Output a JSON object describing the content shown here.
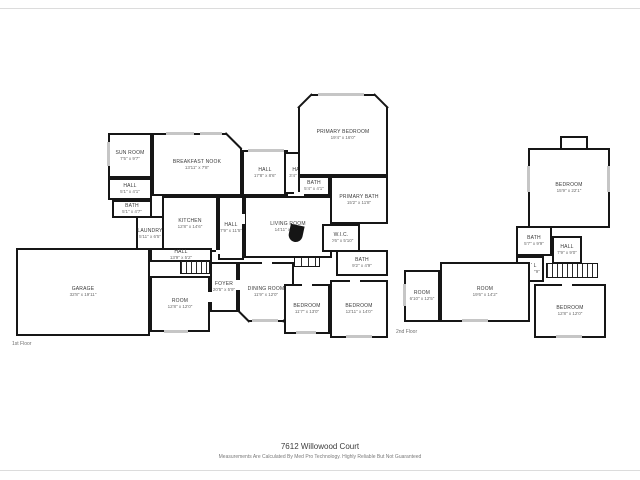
{
  "meta": {
    "address": "7612 Willowood Court",
    "disclaimer": "Measurements Are Calculated By Med Pro Technology. Highly Reliable But Not Guaranteed"
  },
  "floor1": {
    "label": "1st Floor",
    "rooms": [
      {
        "name": "SUN ROOM",
        "dims": "7'5\" x 9'7\""
      },
      {
        "name": "BREAKFAST NOOK",
        "dims": "13'11\" x 7'8\""
      },
      {
        "name": "HALL",
        "dims": "17'8\" x 8'6\""
      },
      {
        "name": "HALL",
        "dims": "3'4\" x 3'9\""
      },
      {
        "name": "PRIMARY BEDROOM",
        "dims": "19'4\" x 16'0\""
      },
      {
        "name": "BATH",
        "dims": "5'4\" x 4'1\""
      },
      {
        "name": "PRIMARY BATH",
        "dims": "15'2\" x 11'8\""
      },
      {
        "name": "KITCHEN",
        "dims": "12'8\" x 14'6\""
      },
      {
        "name": "HALL",
        "dims": "7'9\" x 11'5\""
      },
      {
        "name": "LIVING ROOM",
        "dims": "14'11\" x 17'9\""
      },
      {
        "name": "W.I.C.",
        "dims": "10'6\" x 5'10\""
      },
      {
        "name": "LAUNDRY",
        "dims": "5'11\" x 6'5\""
      },
      {
        "name": "HALL",
        "dims": "5'1\" x 4'1\""
      },
      {
        "name": "BATH",
        "dims": "5'1\" x 4'7\""
      },
      {
        "name": "GARAGE",
        "dims": "32'8\" x 19'11\""
      },
      {
        "name": "HALL",
        "dims": "13'9\" x 5'2\""
      },
      {
        "name": "FOYER",
        "dims": "20'5\" x 5'9\""
      },
      {
        "name": "DINING ROOM",
        "dims": "11'9\" x 12'0\""
      },
      {
        "name": "ROOM",
        "dims": "12'8\" x 12'0\""
      },
      {
        "name": "BEDROOM",
        "dims": "11'7\" x 13'0\""
      },
      {
        "name": "BEDROOM",
        "dims": "12'11\" x 14'0\""
      },
      {
        "name": "BATH",
        "dims": "9'2\" x 4'9\""
      }
    ]
  },
  "floor2": {
    "label": "2nd Floor",
    "rooms": [
      {
        "name": "BEDROOM",
        "dims": "15'9\" x 22'1\""
      },
      {
        "name": "BATH",
        "dims": "5'7\" x 9'9\""
      },
      {
        "name": "HALL",
        "dims": "7'9\" x 9'0\""
      },
      {
        "name": "HALL",
        "dims": "4'3\" x 7'9\""
      },
      {
        "name": "ROOM",
        "dims": "6'10\" x 12'5\""
      },
      {
        "name": "ROOM",
        "dims": "19'6\" x 14'2\""
      },
      {
        "name": "BEDROOM",
        "dims": "12'8\" x 12'0\""
      }
    ]
  }
}
